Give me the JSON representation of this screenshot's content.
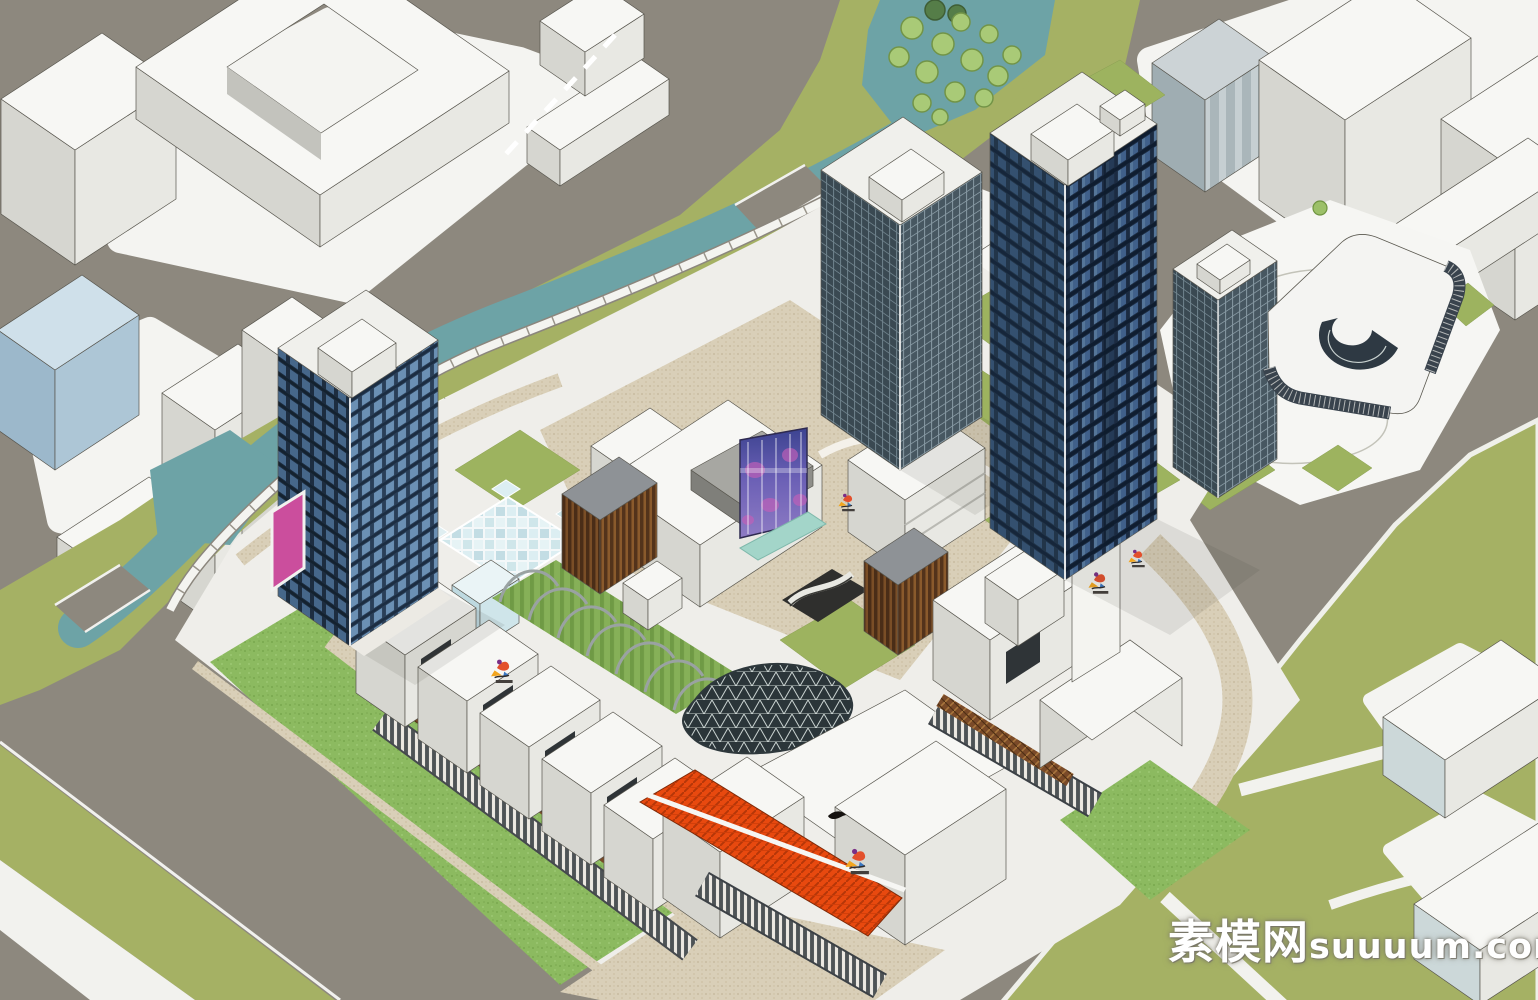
{
  "scene": {
    "kind": "3D architectural massing render (SketchUp style aerial view)",
    "subject": "Mixed-use retail mall podium with glass office towers beside a river, surrounded by white context city blocks"
  },
  "watermark": {
    "site_name": "素模网",
    "site_url": "suuuum.com"
  },
  "palette": {
    "road_gray": "#8d887e",
    "parcel_white": "#f4f4f1",
    "water_teal": "#6da3a6",
    "bank_olive": "#a5b164",
    "lawn_bright": "#8cba60",
    "tower_glass_dark": "#1b2b41",
    "tower_glass_blue": "#40608a",
    "podium_white": "#f2f1ec",
    "feature_orange": "#e8490f",
    "billboard_magenta": "#cb4e9d",
    "led_screen_purple": "#6a5fb5",
    "wood_brown": "#7a4a28",
    "paving_beige": "#d9cfb8",
    "context_blue": "#bfd3e2"
  }
}
